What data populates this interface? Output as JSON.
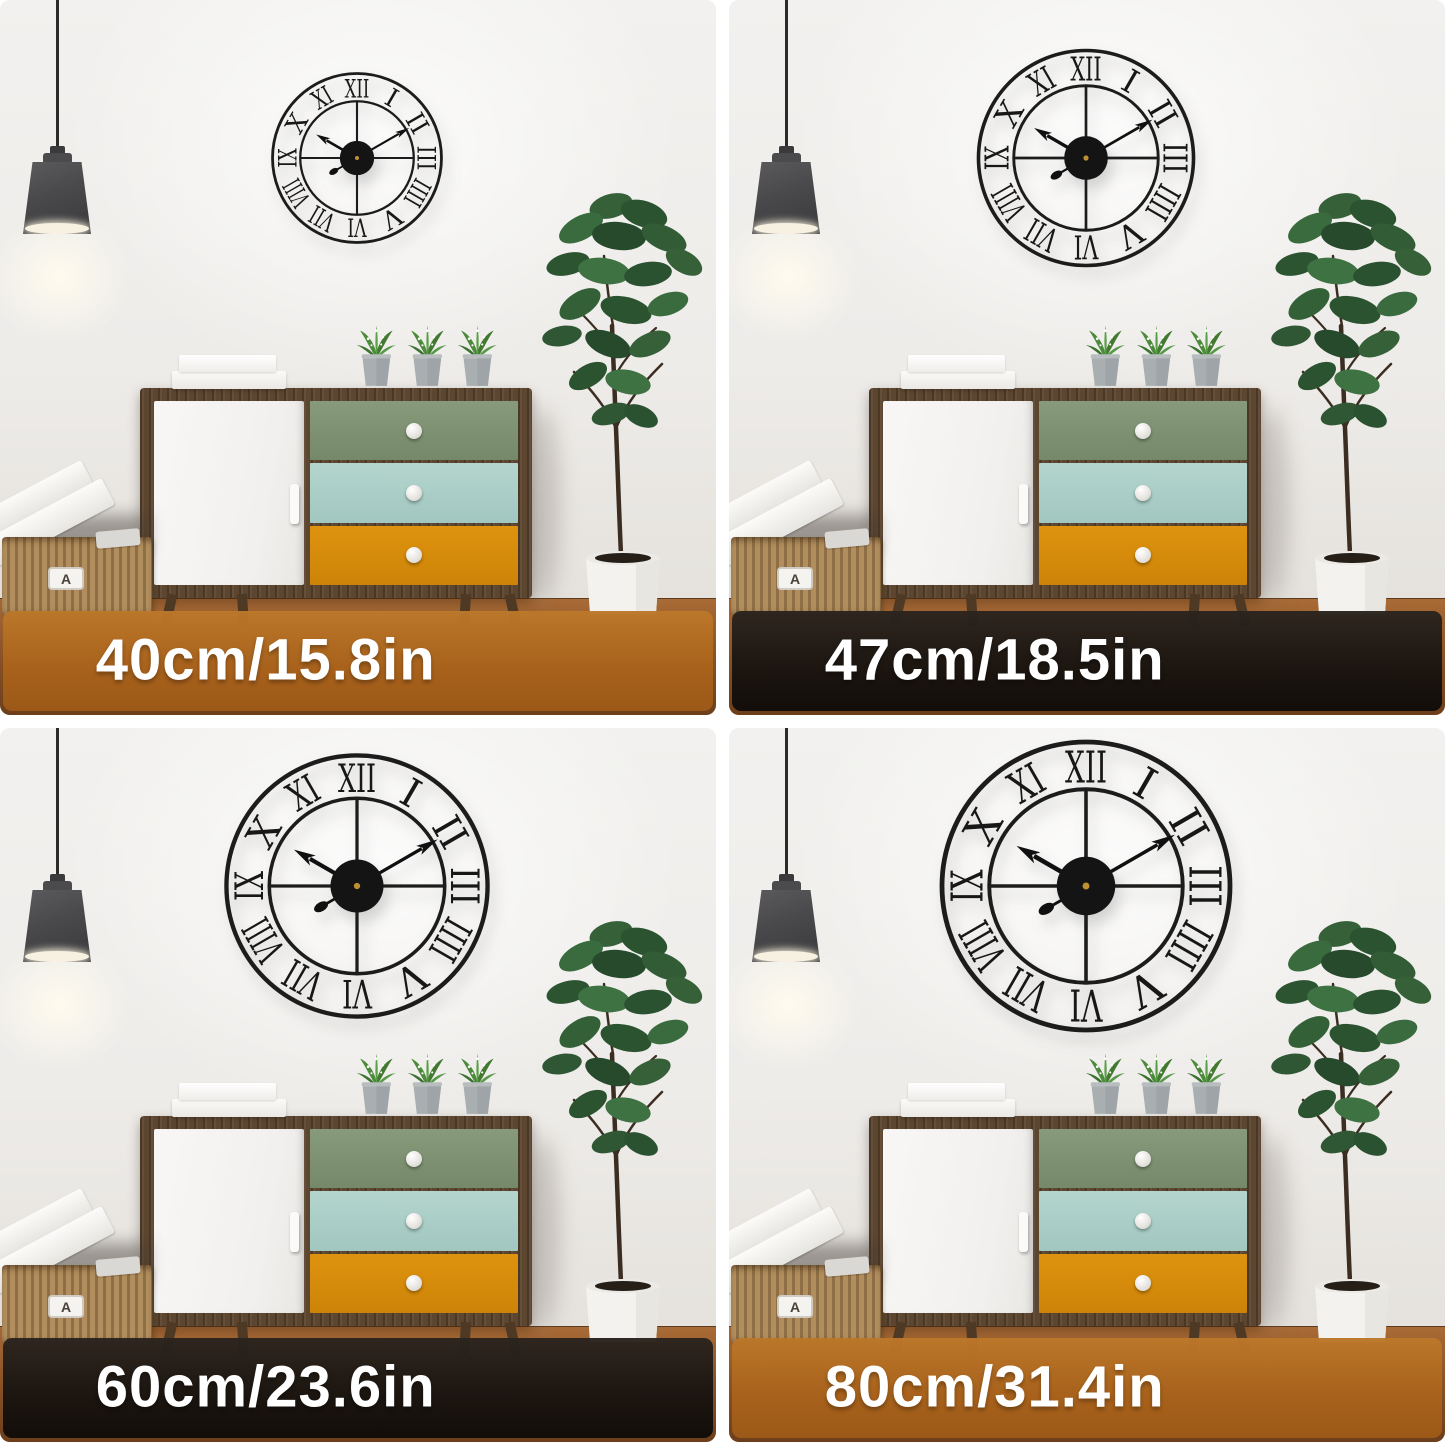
{
  "image_type": "wall clock size comparison collage",
  "clock": {
    "style": "black metal skeleton wall clock with Roman numerals",
    "numerals": [
      "XII",
      "I",
      "II",
      "III",
      "IIII",
      "V",
      "VI",
      "VII",
      "VIII",
      "IX",
      "X",
      "XI"
    ],
    "time_shown": "10:10"
  },
  "scene": {
    "basket_label": "A"
  },
  "colors": {
    "banner_orange": "#b06a22",
    "banner_dark": "#1d1813",
    "banner_text": "#ffffff",
    "clock_metal": "#1c1c1c",
    "wood_frame": "#5d4630",
    "drawer_top_green": "#7d9372",
    "drawer_middle_blue": "#abd0c9",
    "drawer_bottom_orange": "#d8890b",
    "wall": "#edebe8",
    "floor": "#8c5427"
  },
  "panels": [
    {
      "id": "size-40cm",
      "size_label": "40cm/15.8in",
      "banner_style": "orange",
      "clock_diameter_px": 176
    },
    {
      "id": "size-47cm",
      "size_label": "47cm/18.5in",
      "banner_style": "dark",
      "clock_diameter_px": 224
    },
    {
      "id": "size-60cm",
      "size_label": "60cm/23.6in",
      "banner_style": "dark",
      "clock_diameter_px": 272
    },
    {
      "id": "size-80cm",
      "size_label": "80cm/31.4in",
      "banner_style": "orange",
      "clock_diameter_px": 300
    }
  ]
}
